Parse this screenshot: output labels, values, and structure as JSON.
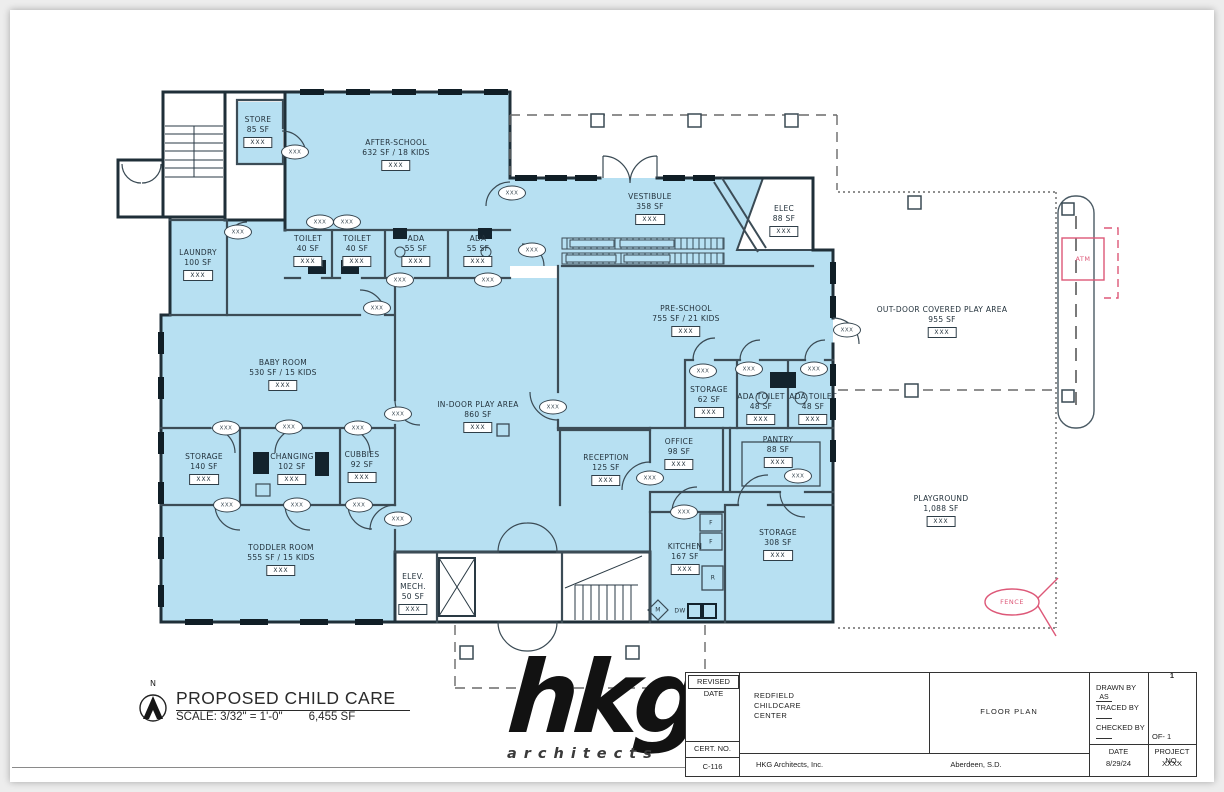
{
  "colors": {
    "room_fill": "#b7e0f2",
    "wall": "#24343e",
    "annotation_pink": "#dd5878"
  },
  "plan": {
    "door_tag_label": "XXX",
    "rooms": [
      {
        "name": "STORE",
        "area": "85 SF",
        "tag": "XXX",
        "x": 258,
        "y": 115
      },
      {
        "name": "AFTER-SCHOOL",
        "area": "632 SF / 18 KIDS",
        "tag": "XXX",
        "x": 396,
        "y": 138
      },
      {
        "name": "LAUNDRY",
        "area": "100 SF",
        "tag": "XXX",
        "x": 198,
        "y": 248
      },
      {
        "name": "TOILET",
        "area": "40 SF",
        "tag": "XXX",
        "x": 308,
        "y": 234
      },
      {
        "name": "TOILET",
        "area": "40 SF",
        "tag": "XXX",
        "x": 357,
        "y": 234
      },
      {
        "name": "ADA",
        "area": "55 SF",
        "tag": "XXX",
        "x": 416,
        "y": 234
      },
      {
        "name": "ADA",
        "area": "55 SF",
        "tag": "XXX",
        "x": 478,
        "y": 234
      },
      {
        "name": "VESTIBULE",
        "area": "358 SF",
        "tag": "XXX",
        "x": 650,
        "y": 192
      },
      {
        "name": "ELEC",
        "area": "88 SF",
        "tag": "XXX",
        "x": 784,
        "y": 204
      },
      {
        "name": "PRE-SCHOOL",
        "area": "755 SF / 21 KIDS",
        "tag": "XXX",
        "x": 686,
        "y": 304
      },
      {
        "name": "STORAGE",
        "area": "62 SF",
        "tag": "XXX",
        "x": 709,
        "y": 385
      },
      {
        "name": "ADA TOILET",
        "area": "48 SF",
        "tag": "XXX",
        "x": 761,
        "y": 392
      },
      {
        "name": "ADA TOILET",
        "area": "48 SF",
        "tag": "XXX",
        "x": 813,
        "y": 392
      },
      {
        "name": "OFFICE",
        "area": "98 SF",
        "tag": "XXX",
        "x": 679,
        "y": 437
      },
      {
        "name": "PANTRY",
        "area": "88 SF",
        "tag": "XXX",
        "x": 778,
        "y": 435
      },
      {
        "name": "BABY ROOM",
        "area": "530 SF / 15 KIDS",
        "tag": "XXX",
        "x": 283,
        "y": 358
      },
      {
        "name": "IN-DOOR PLAY AREA",
        "area": "860 SF",
        "tag": "XXX",
        "x": 478,
        "y": 400
      },
      {
        "name": "STORAGE",
        "area": "140 SF",
        "tag": "XXX",
        "x": 204,
        "y": 452
      },
      {
        "name": "CHANGING",
        "area": "102 SF",
        "tag": "XXX",
        "x": 292,
        "y": 452
      },
      {
        "name": "CUBBIES",
        "area": "92 SF",
        "tag": "XXX",
        "x": 362,
        "y": 450
      },
      {
        "name": "RECEPTION",
        "area": "125 SF",
        "tag": "XXX",
        "x": 606,
        "y": 453
      },
      {
        "name": "TODDLER ROOM",
        "area": "555 SF / 15 KIDS",
        "tag": "XXX",
        "x": 281,
        "y": 543
      },
      {
        "name": "ELEV.\nMECH.",
        "area": "50 SF",
        "tag": "XXX",
        "x": 413,
        "y": 572
      },
      {
        "name": "KITCHEN",
        "area": "167 SF",
        "tag": "XXX",
        "x": 685,
        "y": 542
      },
      {
        "name": "STORAGE",
        "area": "308 SF",
        "tag": "XXX",
        "x": 778,
        "y": 528
      },
      {
        "name": "OUT-DOOR COVERED PLAY AREA",
        "area": "955 SF",
        "tag": "XXX",
        "x": 942,
        "y": 305
      },
      {
        "name": "PLAYGROUND",
        "area": "1,088 SF",
        "tag": "XXX",
        "x": 941,
        "y": 494
      }
    ],
    "door_tags": [
      [
        295,
        152
      ],
      [
        512,
        193
      ],
      [
        320,
        222
      ],
      [
        347,
        222
      ],
      [
        400,
        280
      ],
      [
        488,
        280
      ],
      [
        238,
        232
      ],
      [
        377,
        308
      ],
      [
        398,
        414
      ],
      [
        553,
        407
      ],
      [
        226,
        428
      ],
      [
        289,
        427
      ],
      [
        358,
        428
      ],
      [
        227,
        505
      ],
      [
        297,
        505
      ],
      [
        359,
        505
      ],
      [
        398,
        519
      ],
      [
        532,
        250
      ],
      [
        650,
        478
      ],
      [
        703,
        371
      ],
      [
        749,
        369
      ],
      [
        814,
        369
      ],
      [
        798,
        476
      ],
      [
        684,
        512
      ],
      [
        847,
        330
      ]
    ],
    "fixtures": [
      {
        "label": "F",
        "x": 711,
        "y": 523
      },
      {
        "label": "F",
        "x": 711,
        "y": 542
      },
      {
        "label": "R",
        "x": 713,
        "y": 578
      },
      {
        "label": "M",
        "x": 658,
        "y": 610
      },
      {
        "label": "DW",
        "x": 680,
        "y": 611
      }
    ],
    "annotations": {
      "atm": "ATM",
      "fence": "FENCE"
    }
  },
  "footer": {
    "north_label": "N",
    "title": "PROPOSED CHILD CARE",
    "scale": "SCALE: 3/32\" = 1'-0\"",
    "total_area": "6,455 SF",
    "logo_text": "hkg",
    "logo_sub": "architects"
  },
  "title_block": {
    "revised_date_label": "REVISED DATE",
    "cert_label": "CERT. NO.",
    "cert_no": "C-116",
    "project_name": "REDFIELD\nCHILDCARE\nCENTER",
    "firm": "HKG Architects, Inc.",
    "sheet_title": "FLOOR PLAN",
    "location": "Aberdeen, S.D.",
    "drawn_by_label": "DRAWN BY",
    "drawn_by": "AS",
    "traced_by_label": "TRACED BY",
    "traced_by": "",
    "checked_by_label": "CHECKED BY",
    "checked_by": "",
    "date_label": "DATE",
    "date": "8/29/24",
    "sheet_number": "1",
    "of_label": "OF- 1",
    "project_no_label": "PROJECT NO.",
    "project_no": "XXXX"
  }
}
